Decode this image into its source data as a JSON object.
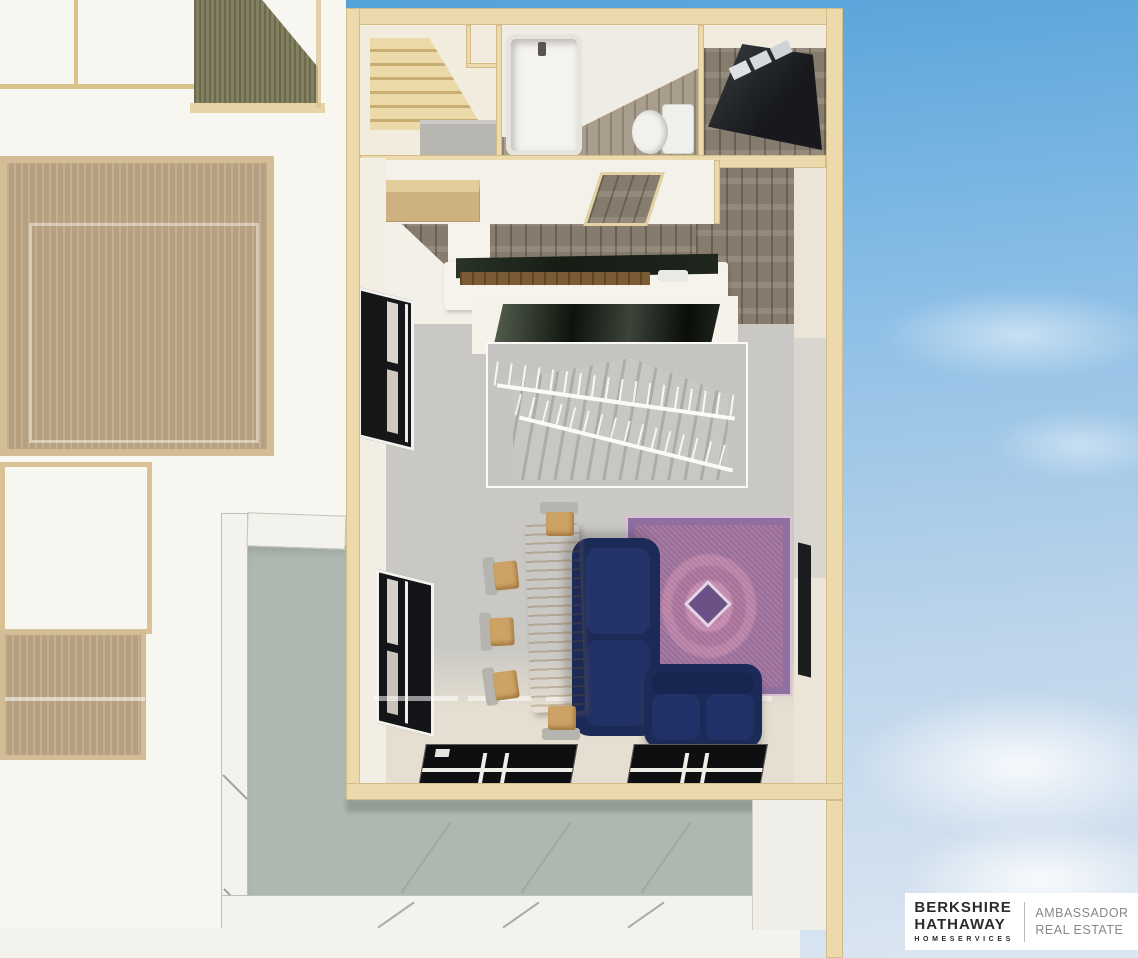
{
  "watermark": {
    "brand_line1": "BERKSHIRE",
    "brand_line2": "HATHAWAY",
    "brand_line3": "HOMESERVICES",
    "right_line1": "AMBASSADOR",
    "right_line2": "REAL ESTATE"
  },
  "colors": {
    "sky_top": "#4fa0da",
    "sky_bottom": "#dbe6f1",
    "wall_tan": "#ecd9ac",
    "wall_tan_dark": "#d9c28c",
    "interior_cream": "#f2ecdf",
    "roof_white": "#f8f6f0",
    "corrugated_olive": "#7d7a61",
    "carpet_tan": "#c0a988",
    "deck_sage": "#aeb8b0",
    "railing_white": "#f3f2ed",
    "wood_floor": "#8f8576",
    "living_floor": "#c9c8c4",
    "living_floor_warm": "#e6dfd1",
    "sofa_navy": "#1c2a58",
    "table_wood": "#cda365",
    "rug_purple": "#8f6f9f",
    "rug_pink": "#c2799c",
    "door_black": "#26292c",
    "counter_dark": "#20291f",
    "cabinet_wood": "#7c5c35",
    "stair_wood": "#ecd9a9",
    "logo_dark": "#2b2b2b",
    "logo_gray": "#85888c"
  }
}
